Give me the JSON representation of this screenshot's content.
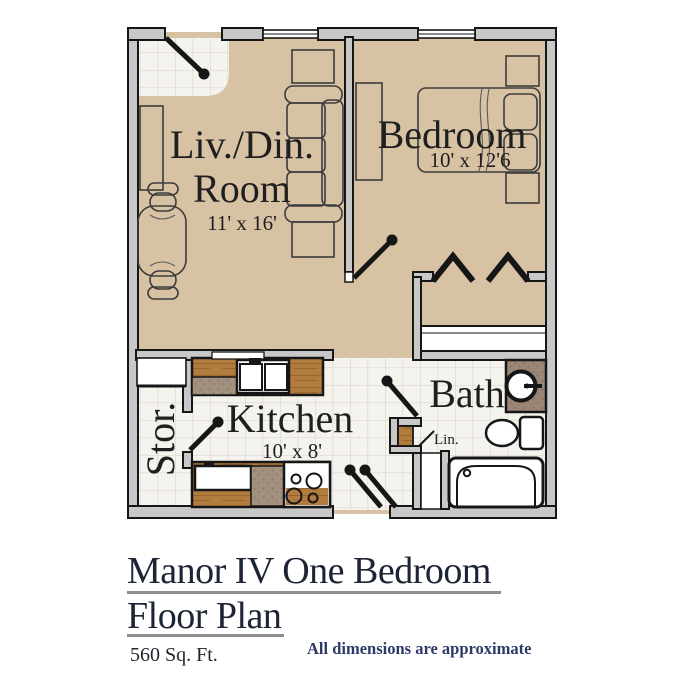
{
  "plan": {
    "living": {
      "label_line1": "Liv./Din.",
      "label_line2": "Room",
      "dims": "11' x 16'"
    },
    "bedroom": {
      "label": "Bedroom",
      "dims": "10' x 12'6"
    },
    "kitchen": {
      "label": "Kitchen",
      "dims": "10' x 8'"
    },
    "bath": {
      "label": "Bath"
    },
    "storage": {
      "label": "Stor."
    },
    "linen": {
      "label": "Lin."
    }
  },
  "footer": {
    "title_line1": "Manor IV One Bedroom",
    "title_line2": "Floor Plan",
    "area": "560 Sq. Ft.",
    "note": "All dimensions are approximate"
  },
  "colors": {
    "floor_tan": "#d8c2a4",
    "tile": "#f5f3ee",
    "tile_grid": "#dcd7cf",
    "wall_gray": "#c8c8c8",
    "line_black": "#161616",
    "wood": "#b17c3e",
    "wood_grain": "#8a5c24",
    "speckle": "#a2917f",
    "speckle_dot": "#8a7865",
    "vanity": "#9b8574",
    "vanity_dot": "#857060",
    "title_navy": "#1d2436",
    "note_navy": "#2e3a66",
    "underline_gray": "#8e8e8e"
  }
}
